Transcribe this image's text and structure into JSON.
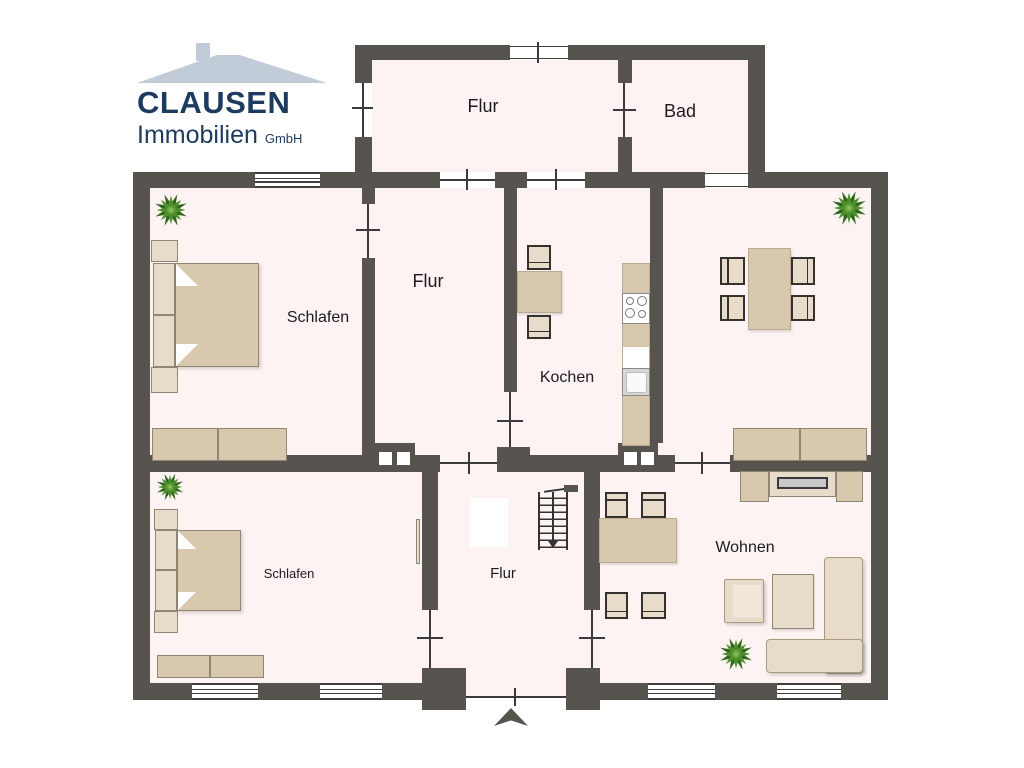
{
  "logo": {
    "company": "CLAUSEN",
    "brand_line": "Immobilien",
    "suffix": "GmbH"
  },
  "rooms": {
    "flur_top": "Flur",
    "bad": "Bad",
    "schlafen_top": "Schlafen",
    "flur_middle": "Flur",
    "kochen": "Kochen",
    "wohnen": "Wohnen",
    "schlafen_bottom": "Schlafen",
    "flur_bottom": "Flur"
  },
  "colors": {
    "wall": "#57534f",
    "floor": "#fdf3f2",
    "furn": "#d8c9ae",
    "furnl": "#e7dcc9",
    "furnb": "#8f8674",
    "navy": "#1d3a5f",
    "roof": "#c2cbd8",
    "tv": "#c9c9c9",
    "plant_green": "#4d8f2c",
    "plant_dark": "#2e661b"
  }
}
